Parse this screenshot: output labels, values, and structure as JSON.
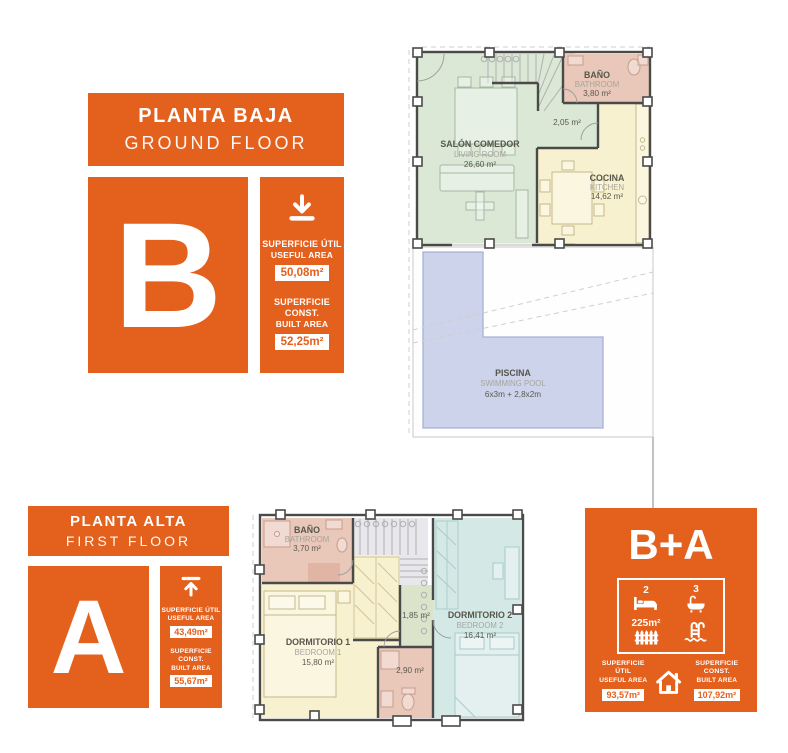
{
  "palette": {
    "orange": "#e4601d",
    "living_green": "#dbe8d6",
    "kitchen_yellow": "#f8f1cf",
    "bath_pink": "#e9c7b9",
    "bedroom2_teal": "#d4e9e6",
    "pool_blue": "#ccd3ea",
    "stairs_gray": "#e7e7ec"
  },
  "blockB": {
    "title": "PLANTA BAJA",
    "subtitle": "GROUND FLOOR",
    "letter": "B",
    "useful": {
      "es": "SUPERFICIE ÚTIL",
      "en": "USEFUL AREA",
      "value": "50,08m²"
    },
    "built": {
      "es": "SUPERFICIE CONST.",
      "en": "BUILT AREA",
      "value": "52,25m²"
    }
  },
  "blockA": {
    "title": "PLANTA ALTA",
    "subtitle": "FIRST FLOOR",
    "letter": "A",
    "useful": {
      "es": "SUPERFICIE ÚTIL",
      "en": "USEFUL AREA",
      "value": "43,49m²"
    },
    "built": {
      "es": "SUPERFICIE CONST.",
      "en": "BUILT AREA",
      "value": "55,67m²"
    }
  },
  "summary": {
    "letters": "B+A",
    "bedrooms": "2",
    "bathrooms": "3",
    "plot": "225m²",
    "useful": {
      "es": "SUPERFICIE ÚTIL",
      "en": "USEFUL AREA",
      "value": "93,57m²"
    },
    "built": {
      "es": "SUPERFICIE CONST.",
      "en": "BUILT AREA",
      "value": "107,92m²"
    }
  },
  "planB": {
    "living": {
      "name": "SALÓN COMEDOR",
      "en": "LIVING ROOM",
      "area": "26,60 m²"
    },
    "bath": {
      "name": "BAÑO",
      "en": "BATHROOM",
      "area": "3,80 m²"
    },
    "kitchen": {
      "name": "COCINA",
      "en": "KITCHEN",
      "area": "14,62 m²"
    },
    "hall": {
      "area": "2,05 m²"
    },
    "pool": {
      "name": "PISCINA",
      "en": "SWIMMING POOL",
      "dims": "6x3m + 2,8x2m"
    }
  },
  "planA": {
    "bath": {
      "name": "BAÑO",
      "en": "BATHROOM",
      "area": "3,70 m²"
    },
    "bed1": {
      "name": "DORMITORIO 1",
      "en": "BEDROOM 1",
      "area": "15,80 m²"
    },
    "bed2": {
      "name": "DORMITORIO 2",
      "en": "BEDROOM 2",
      "area": "16,41 m²"
    },
    "hall": {
      "area": "1,85 m²"
    },
    "wc": {
      "area": "2,90 m²"
    }
  }
}
